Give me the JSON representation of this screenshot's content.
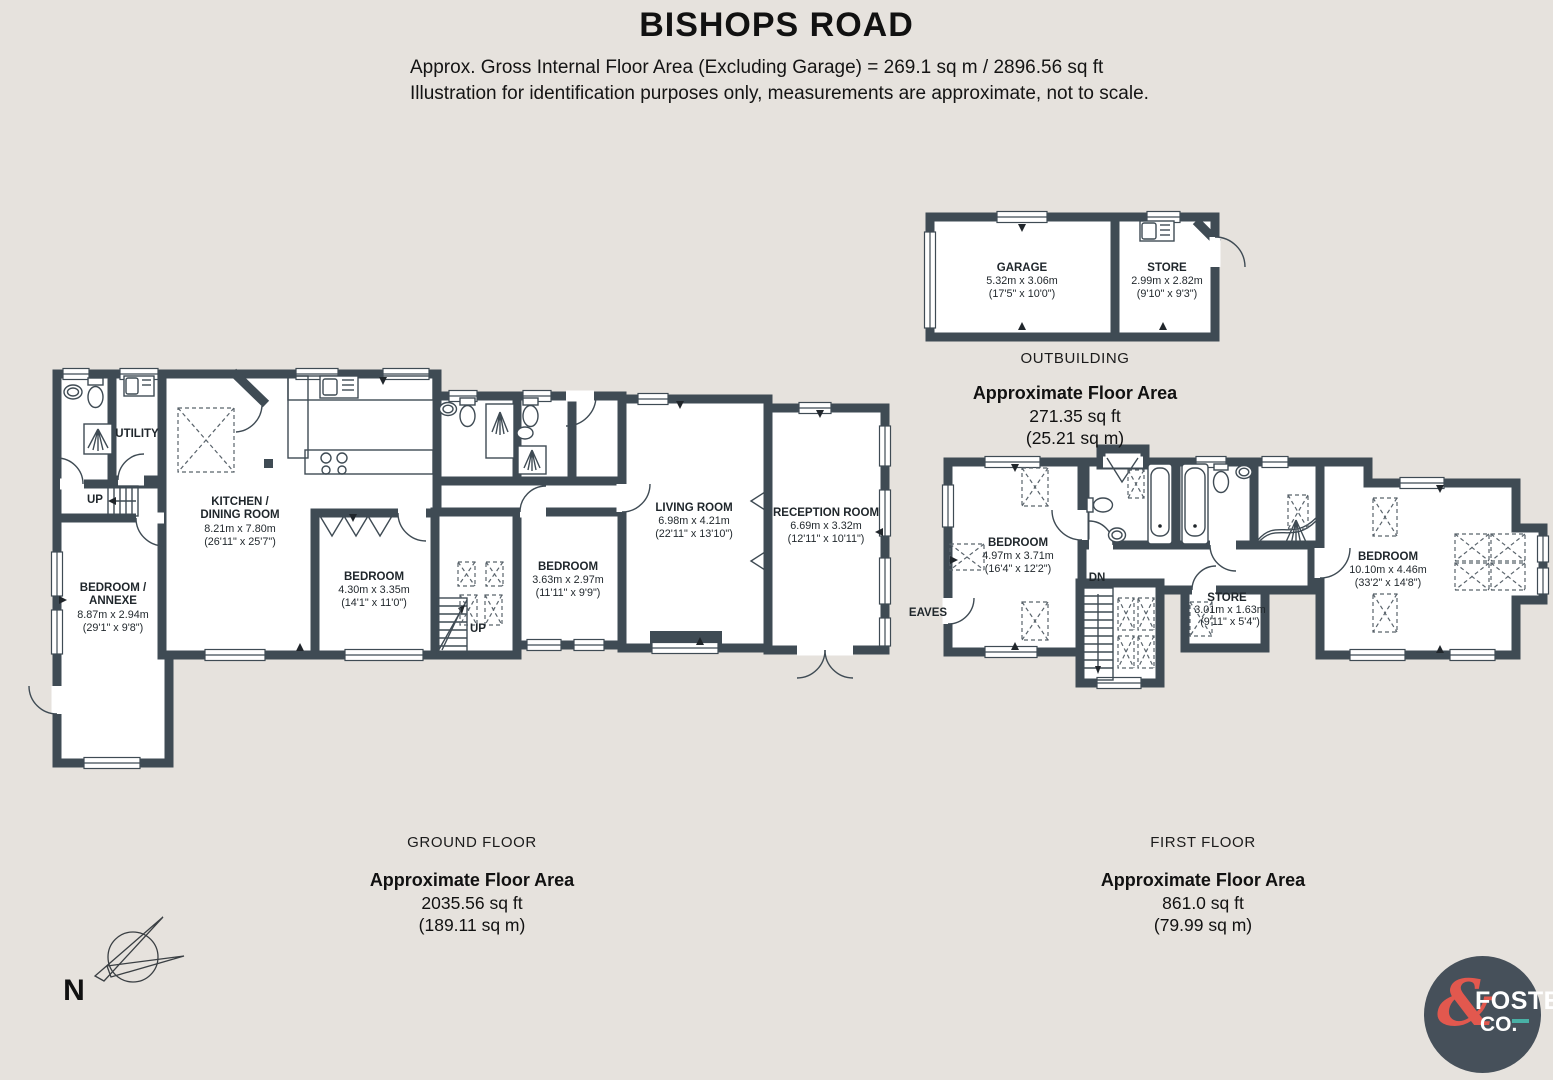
{
  "header": {
    "title": "BISHOPS ROAD",
    "subtitle_line1": "Approx. Gross Internal Floor Area (Excluding Garage) = 269.1 sq m / 2896.56 sq ft",
    "subtitle_line2": "Illustration for identification purposes only, measurements are approximate, not to scale."
  },
  "outbuilding": {
    "label": "OUTBUILDING",
    "area_heading": "Approximate Floor Area",
    "area_ft": "271.35 sq ft",
    "area_m": "(25.21 sq m)",
    "garage": {
      "name": "GARAGE",
      "metric": "5.32m x 3.06m",
      "imperial": "(17'5\" x 10'0\")"
    },
    "store": {
      "name": "STORE",
      "metric": "2.99m x 2.82m",
      "imperial": "(9'10\" x 9'3\")"
    }
  },
  "ground_floor": {
    "label": "GROUND FLOOR",
    "area_heading": "Approximate Floor Area",
    "area_ft": "2035.56 sq ft",
    "area_m": "(189.11 sq m)",
    "utility": {
      "name": "UTILITY"
    },
    "stairs_up_annexe": "UP",
    "stairs_up_main": "UP",
    "bedroom_annexe": {
      "name_line1": "BEDROOM /",
      "name_line2": "ANNEXE",
      "metric": "8.87m x 2.94m",
      "imperial": "(29'1\" x 9'8\")"
    },
    "kitchen_dining": {
      "name_line1": "KITCHEN /",
      "name_line2": "DINING ROOM",
      "metric": "8.21m x 7.80m",
      "imperial": "(26'11\" x 25'7\")"
    },
    "bedroom_1": {
      "name": "BEDROOM",
      "metric": "4.30m x 3.35m",
      "imperial": "(14'1\" x 11'0\")"
    },
    "bedroom_2": {
      "name": "BEDROOM",
      "metric": "3.63m x 2.97m",
      "imperial": "(11'11\" x 9'9\")"
    },
    "living_room": {
      "name": "LIVING ROOM",
      "metric": "6.98m x 4.21m",
      "imperial": "(22'11\" x 13'10\")"
    },
    "reception_room": {
      "name": "RECEPTION ROOM",
      "metric": "6.69m x 3.32m",
      "imperial": "(12'11\" x 10'11\")"
    }
  },
  "first_floor": {
    "label": "FIRST FLOOR",
    "area_heading": "Approximate Floor Area",
    "area_ft": "861.0 sq ft",
    "area_m": "(79.99 sq m)",
    "stairs_dn": "DN",
    "eaves": "EAVES",
    "bedroom_left": {
      "name": "BEDROOM",
      "metric": "4.97m x 3.71m",
      "imperial": "(16'4\" x 12'2\")"
    },
    "store": {
      "name": "STORE",
      "metric": "3.01m x 1.63m",
      "imperial": "(9'11\" x 5'4\")"
    },
    "bedroom_right": {
      "name": "BEDROOM",
      "metric": "10.10m x 4.46m",
      "imperial": "(33'2\" x 14'8\")"
    }
  },
  "compass": {
    "north": "N"
  },
  "logo": {
    "ampersand": "&",
    "name": "FOSTER",
    "suffix": "CO."
  },
  "colors": {
    "background": "#e6e2dd",
    "wall": "#3f4b54",
    "logo_circle": "#46505a",
    "logo_accent": "#e2584e",
    "logo_teal": "#49b1a6"
  }
}
